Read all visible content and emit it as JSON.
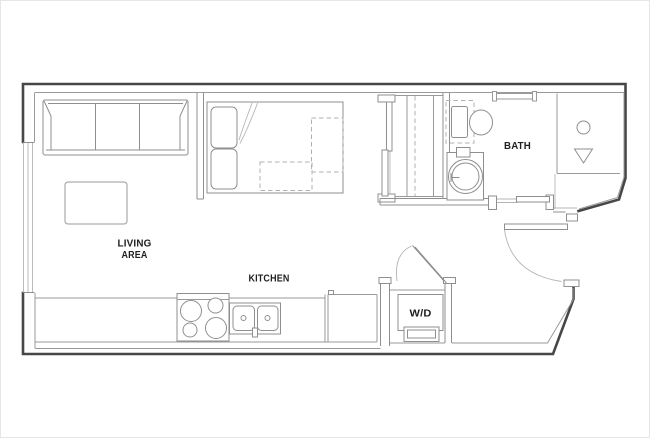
{
  "plan": {
    "rooms": {
      "living_area": {
        "label_line1": "LIVING",
        "label_line2": "AREA"
      },
      "kitchen": {
        "label": "KITCHEN"
      },
      "bath": {
        "label": "BATH"
      },
      "laundry_closet": {
        "label": "W/D"
      }
    },
    "fixtures": [
      "sofa",
      "coffee-table",
      "bed",
      "closet-sliding-doors",
      "closet-shelving",
      "toilet",
      "vanity-sink",
      "shower",
      "shower-glass",
      "range-stove",
      "kitchen-sink",
      "kitchen-counter",
      "washer-dryer",
      "entry-door",
      "bathroom-sliding-door",
      "window"
    ]
  },
  "colors": {
    "wall": "#474747",
    "line": "#8f8f8f",
    "light_line": "#9a9a9a",
    "faint_line": "#b5b5b5",
    "dash_line": "#b0b0b0",
    "text": "#1f1f1f",
    "background": "#ffffff",
    "border": "#e6e6e6"
  }
}
